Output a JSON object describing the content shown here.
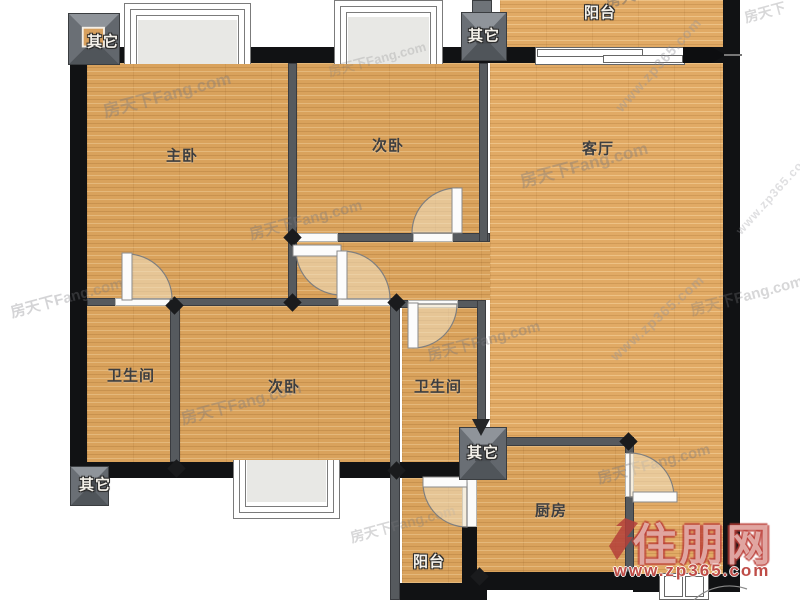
{
  "floorplan": {
    "rooms": [
      {
        "id": "master-bedroom",
        "label": "主卧"
      },
      {
        "id": "second-bedroom-top",
        "label": "次卧"
      },
      {
        "id": "living-room",
        "label": "客厅"
      },
      {
        "id": "balcony-top",
        "label": "阳台"
      },
      {
        "id": "bathroom-left",
        "label": "卫生间"
      },
      {
        "id": "second-bedroom-bottom",
        "label": "次卧"
      },
      {
        "id": "bathroom-right",
        "label": "卫生间"
      },
      {
        "id": "kitchen",
        "label": "厨房"
      },
      {
        "id": "balcony-bottom",
        "label": "阳台"
      }
    ],
    "shafts": [
      {
        "label": "其它"
      },
      {
        "label": "其它"
      },
      {
        "label": "其它"
      },
      {
        "label": "其它"
      }
    ],
    "watermarks": {
      "fang_full": "房天下Fang.com",
      "fang_short": "房天下",
      "zp_url": "www.zp365.com",
      "zp_name": "住朋网"
    },
    "colors": {
      "wood": "#d9a25c",
      "wall_outer": "#111214",
      "wall_inner": "#565a5e",
      "watermark_red": "#b4403a"
    }
  }
}
